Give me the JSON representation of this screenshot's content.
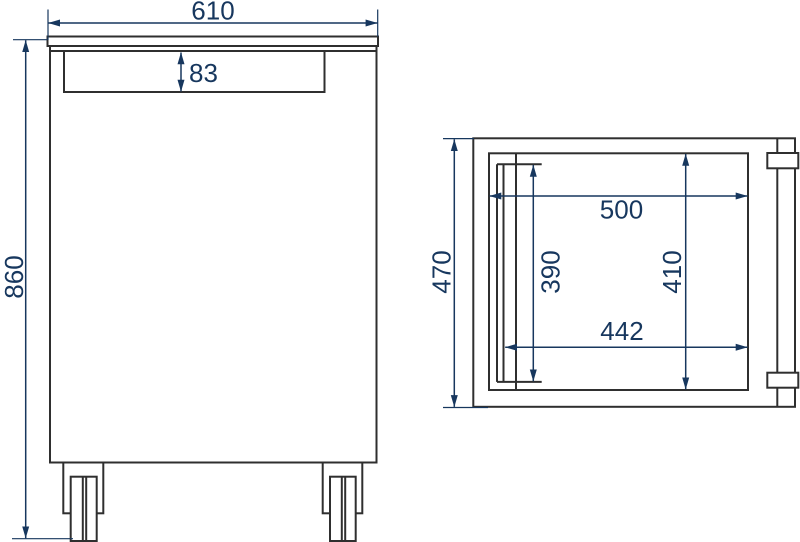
{
  "colors": {
    "dimension_blue": "#17375e",
    "outline_dark": "#2f2f2f",
    "background": "#ffffff"
  },
  "front_view": {
    "dim_width": "610",
    "dim_height": "860",
    "dim_top_panel": "83"
  },
  "side_view": {
    "dim_depth": "470",
    "dim_inner_width": "500",
    "dim_inner_bottom_width": "442",
    "dim_inner_left_height": "390",
    "dim_inner_right_height": "410"
  }
}
